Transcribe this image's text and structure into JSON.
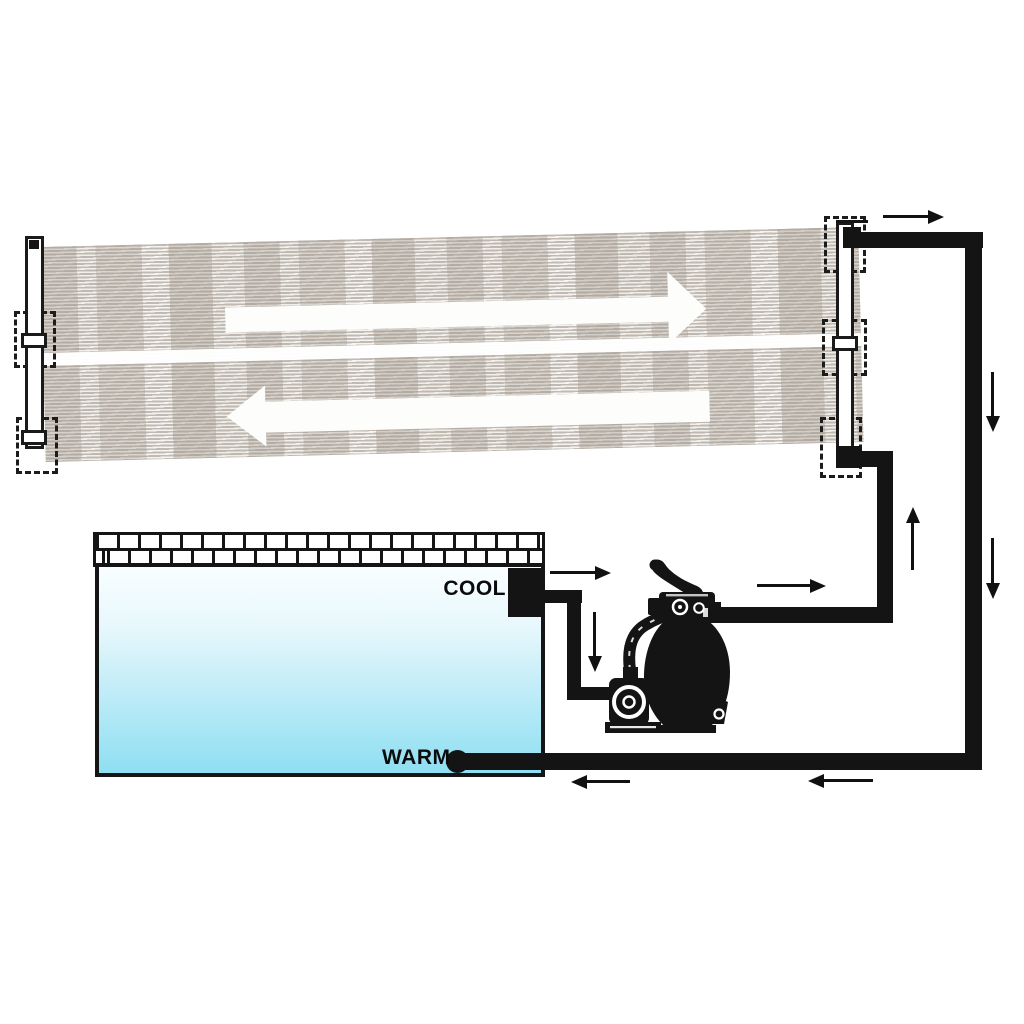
{
  "labels": {
    "cool": "COOL",
    "warm": "WARM"
  },
  "colors": {
    "background": "#ffffff",
    "pipe": "#141414",
    "outline": "#1a1a1a",
    "flow_arrow": "#111111",
    "mat_stripe": "#c3bcb4",
    "mat_bg": "#faf9f7",
    "pool_water_top": "#f9feff",
    "pool_water_mid": "#c3edf8",
    "pool_water_bottom": "#8edff2",
    "panel_arrow": "#fdfdfc"
  },
  "components": {
    "solar_collector": {
      "name": "striped solar heating mat with left and right manifolds",
      "internal_flow_arrows": [
        "right",
        "left"
      ]
    },
    "pool": {
      "name": "swimming pool with tiled edge",
      "ports": [
        "COOL",
        "WARM"
      ]
    },
    "pump": {
      "name": "sand filter pump with multiport valve"
    },
    "flow_arrows": [
      {
        "id": "pool-outlet",
        "direction": "right"
      },
      {
        "id": "suction-down",
        "direction": "down"
      },
      {
        "id": "pump-outlet",
        "direction": "right"
      },
      {
        "id": "panel-feed-up",
        "direction": "up"
      },
      {
        "id": "panel-outlet",
        "direction": "right"
      },
      {
        "id": "return-down-upper",
        "direction": "down"
      },
      {
        "id": "return-down-lower",
        "direction": "down"
      },
      {
        "id": "return-left-outer",
        "direction": "left"
      },
      {
        "id": "return-left-inner",
        "direction": "left"
      }
    ]
  }
}
